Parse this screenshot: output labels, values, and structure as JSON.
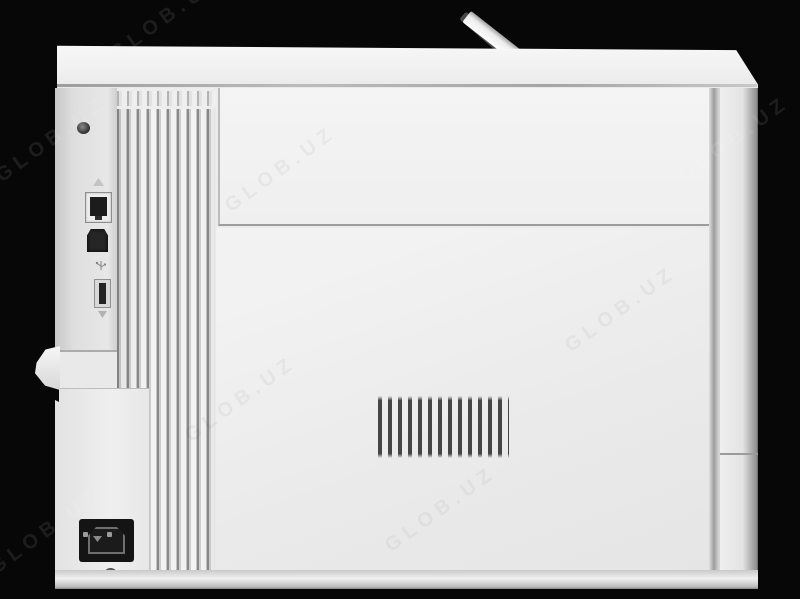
{
  "scene": {
    "type": "product-photo",
    "subject": "rear view of a white laser printer",
    "background_color": "#070707",
    "body_color": "#ececec",
    "panel_color": "#f2f2f2"
  },
  "watermark": {
    "text": "GLOB.UZ"
  },
  "printer": {
    "ports": [
      {
        "name": "ethernet-port"
      },
      {
        "name": "usb-b-port"
      },
      {
        "name": "usb-a-port"
      },
      {
        "name": "power-inlet-c14"
      }
    ],
    "vents": {
      "center_slot_count": 13,
      "side_slat_count": 10
    },
    "features": [
      "raised-paper-stop",
      "rear-door",
      "door-release-tab",
      "screws"
    ]
  }
}
